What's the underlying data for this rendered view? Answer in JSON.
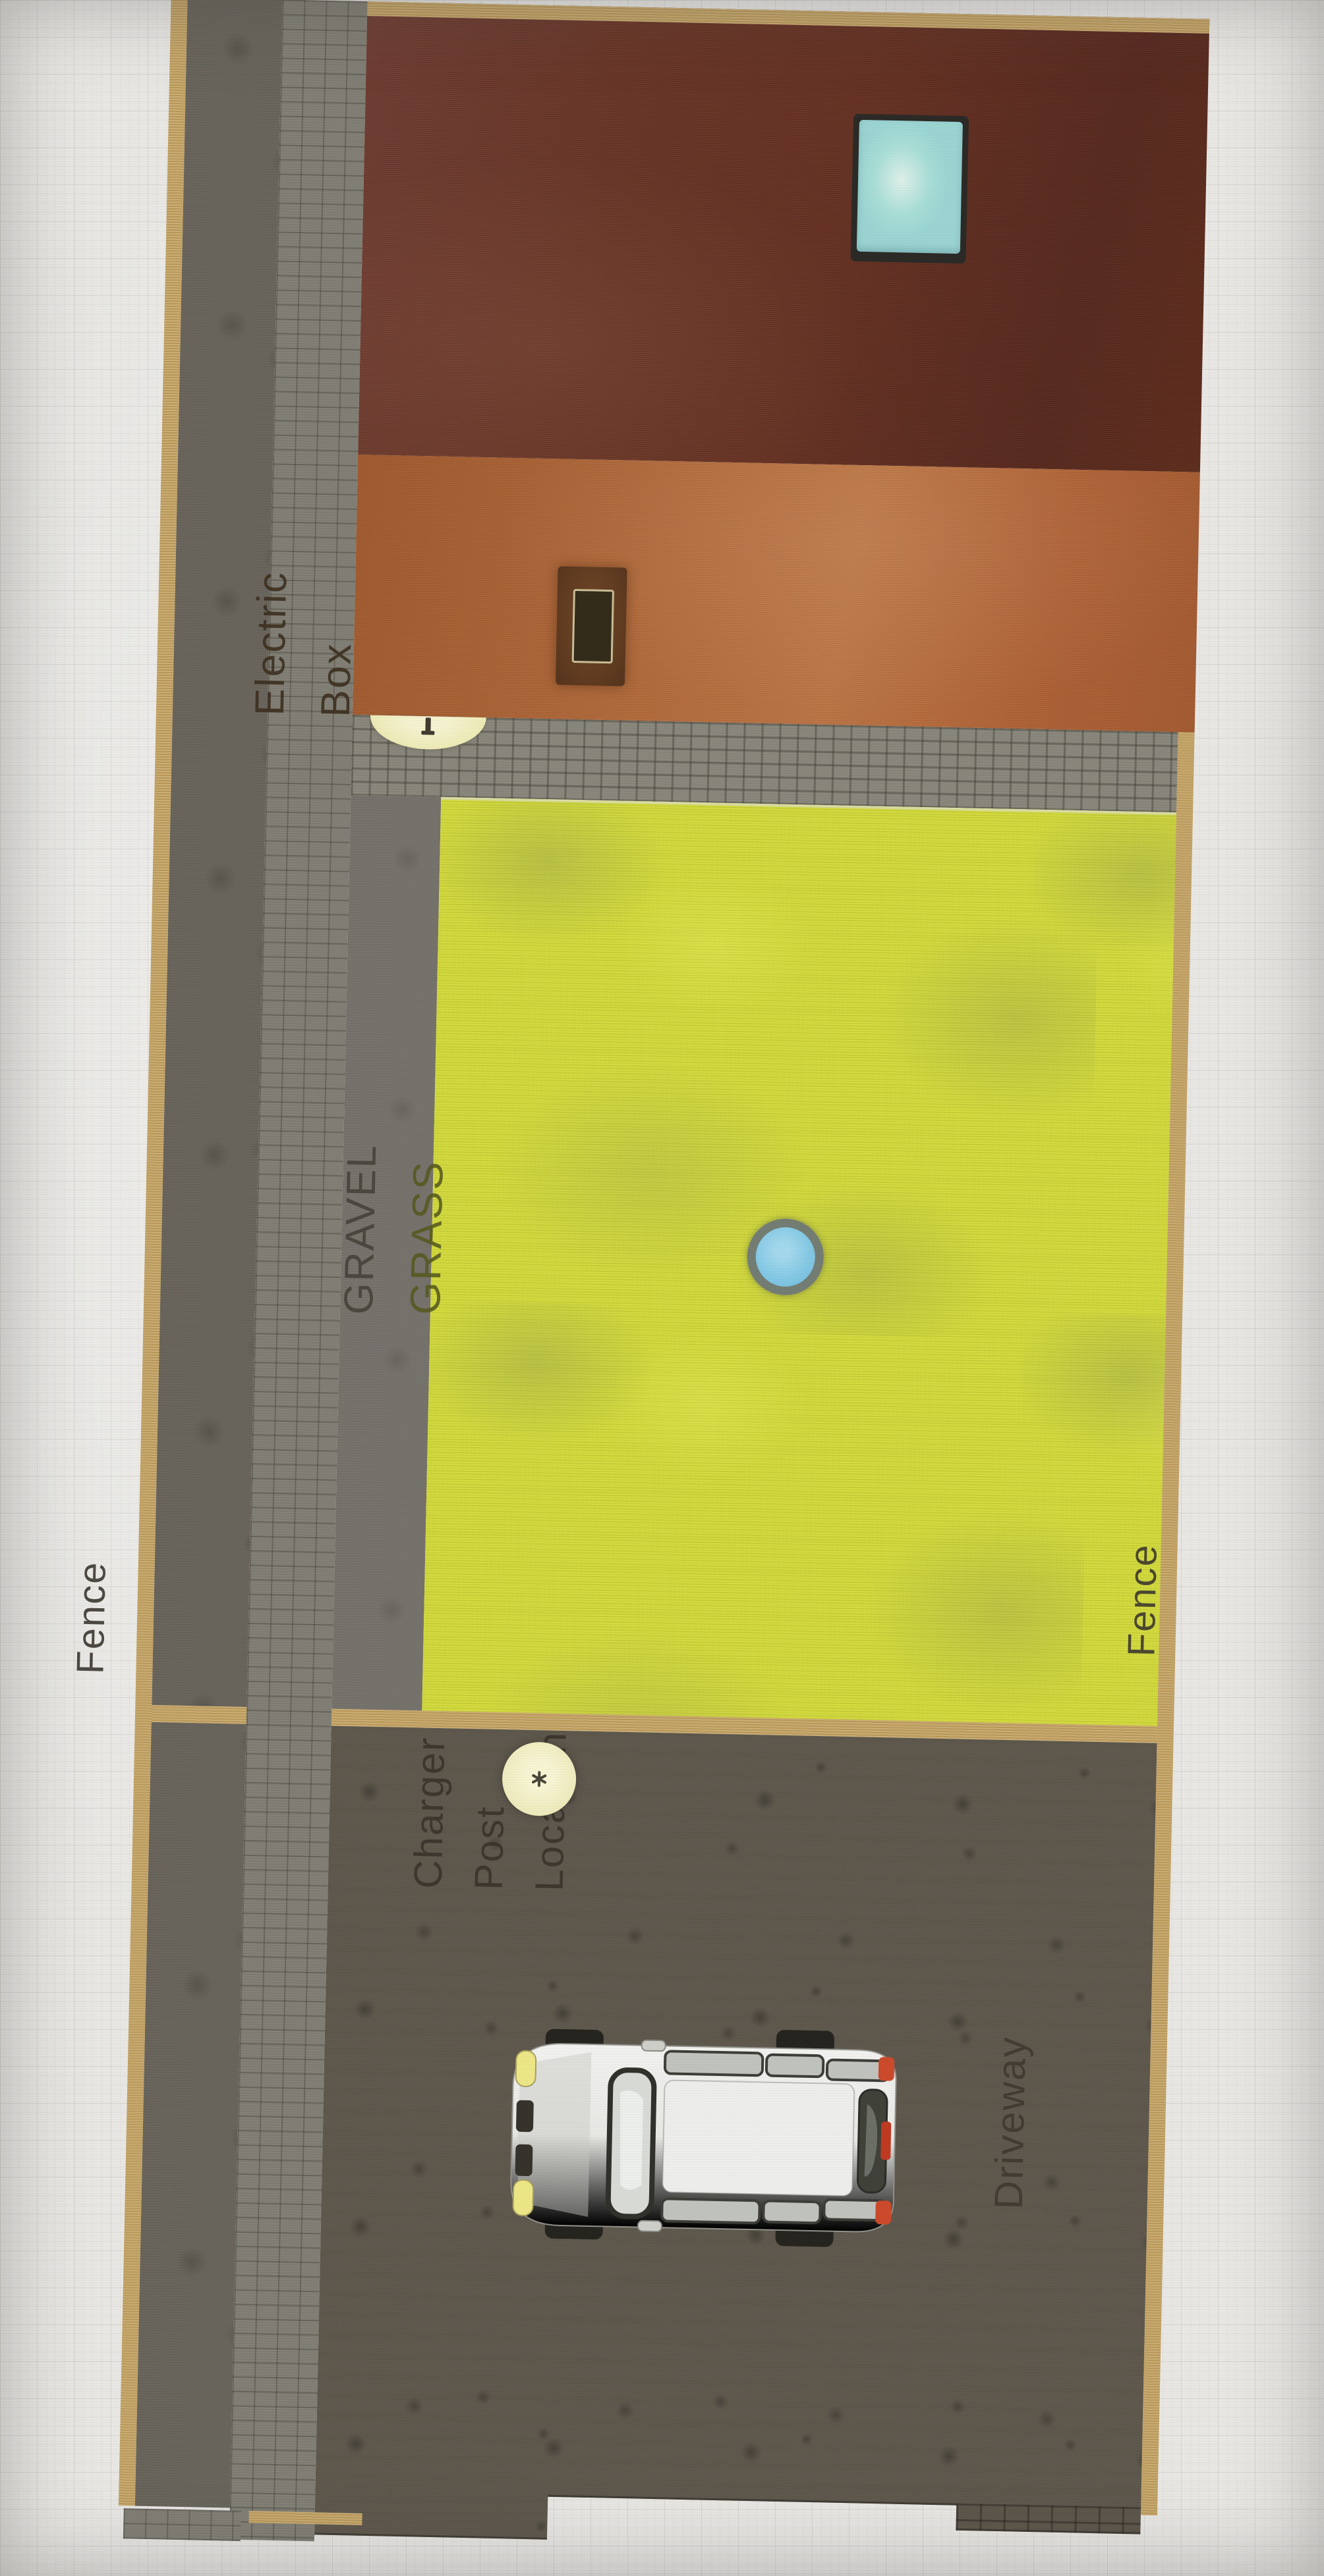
{
  "scene": {
    "type": "backyard site plan",
    "background_color": "#e8e7e4"
  },
  "plan": {
    "labels": {
      "electric_box": {
        "line1": "Electric",
        "line2": "Box"
      },
      "gravel": "GRAVEL",
      "grass": "GRASS",
      "fence_left": "Fence",
      "fence_right": "Fence",
      "charger": {
        "line1": "Charger",
        "line2": "Post",
        "line3": "Location"
      },
      "driveway": "Driveway"
    },
    "colors": {
      "fence_line": "#c2a160",
      "roof_upper_slope": "#6a3526",
      "roof_lower_slope": "#b06a3c",
      "skylight_glass": "#a8ddd6",
      "grass": "#d2d93e",
      "gravel_strip": "#74706a",
      "brick_path": "#7f7d73",
      "driveway": "#5c564b",
      "marker_yellow": "#efecbe",
      "sprinkler_blue": "#82c7e3",
      "car_body": "#eceae8"
    },
    "markers": {
      "electric_box_marker": "yellow semicircle at roof edge",
      "charger_post_marker": "yellow circle on driveway",
      "sprinkler_marker": "blue circle in grass"
    },
    "vehicle": {
      "kind": "van seen from above",
      "facing": "left"
    }
  }
}
